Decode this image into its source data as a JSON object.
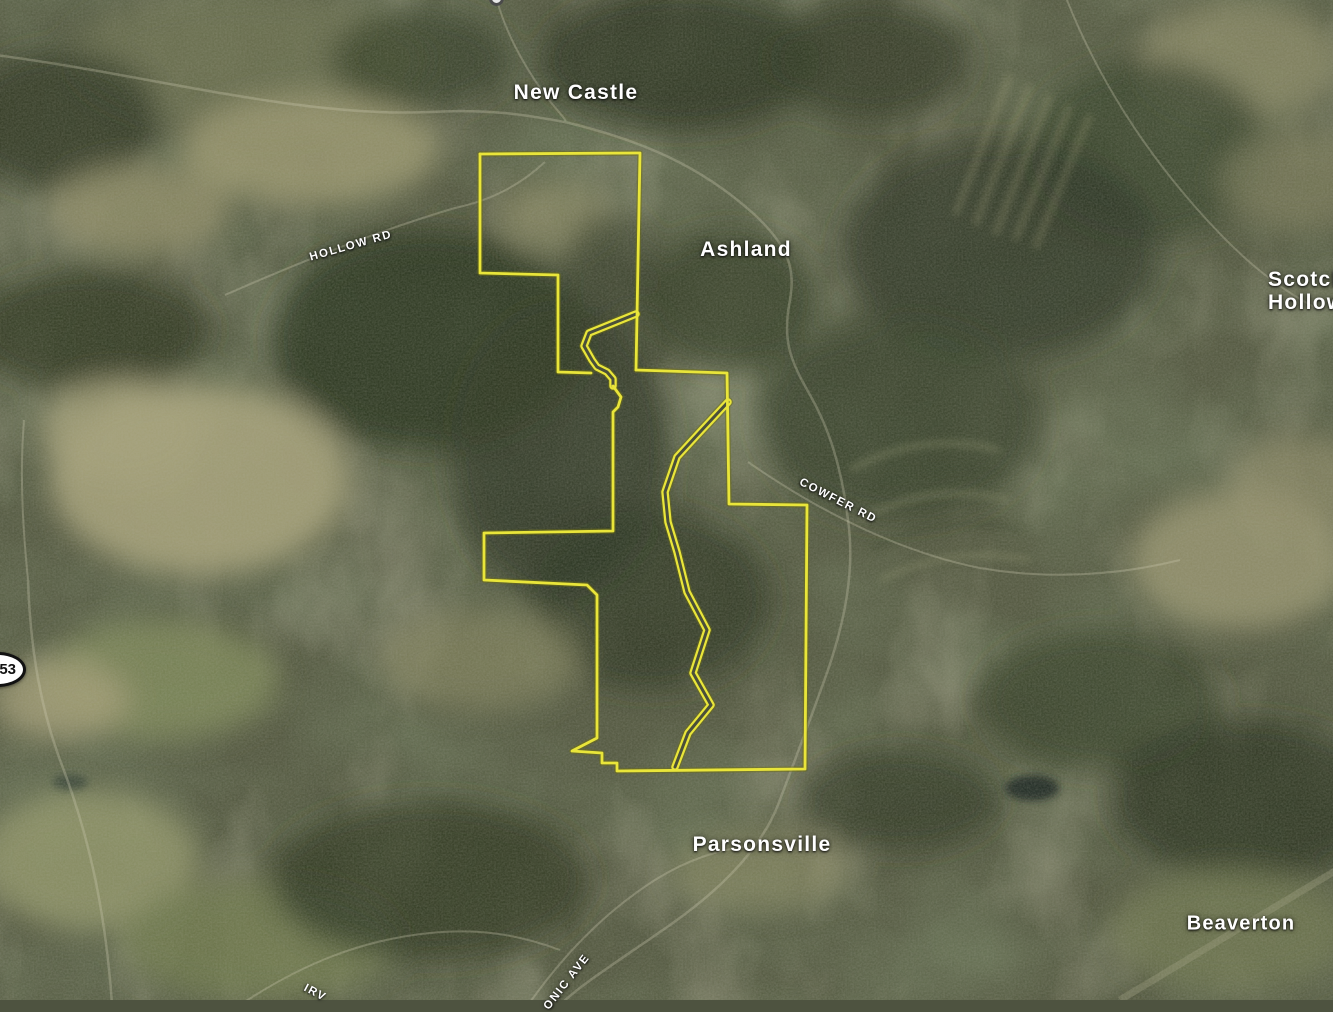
{
  "map": {
    "view_type": "satellite",
    "place_labels": [
      {
        "name": "New Castle"
      },
      {
        "name": "Ashland"
      },
      {
        "name": "Scotch Hollow",
        "line1": "Scotch",
        "line2": "Hollow"
      },
      {
        "name": "Parsonsville"
      },
      {
        "name": "Beaverton"
      }
    ],
    "road_labels": [
      {
        "name": "HOLLOW RD"
      },
      {
        "name": "COWFER RD"
      },
      {
        "name": "IRV"
      },
      {
        "name": "ONIC AVE"
      }
    ],
    "route_shield": {
      "number": "53"
    },
    "boundary": {
      "color": "#e9e53a",
      "main_a": "M 480 154 L 640 153 L 636 370",
      "main_b": "M 480 154 L 480 273 L 558 275 L 558 372 L 591 373",
      "main_c": "M 636 370 L 727 373 L 729 504 L 807 505 L 805 769 L 617 771 L 617 763 L 602 763 L 602 753 L 572 751 L 597 738 L 597 595 L 587 585 L 484 580 L 484 533 L 613 531 L 613 412 L 618 407 L 621 397 L 613 386",
      "neck_corridor": "M 636 314 L 589 333 L 584 346 L 592 360 L 597 367 L 607 372 L 613 379 L 613 386",
      "east_corridor": "M 728 402 L 700 432 L 677 457 L 665 492 L 668 522 L 677 552 L 687 592 L 707 630 L 693 673 L 711 705 L 688 733 L 675 767"
    }
  }
}
